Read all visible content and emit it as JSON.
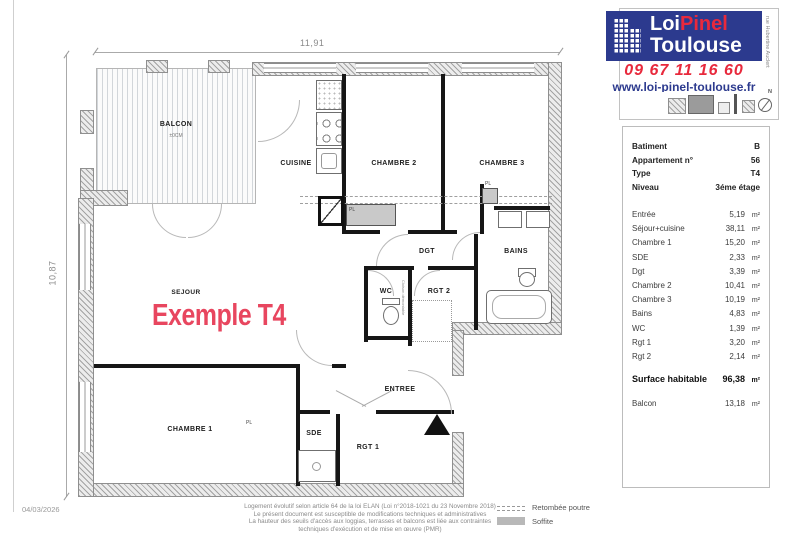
{
  "branding": {
    "logo": {
      "word1": "Loi",
      "word2": "Pinel",
      "word3": "Toulouse"
    },
    "phone": "09 67 11 16 60",
    "website": "www.loi-pinel-toulouse.fr",
    "street": "rue Hubertine Auclert",
    "compass": "N",
    "colors": {
      "navy": "#2c3a8e",
      "red": "#e8293c",
      "pink": "#e8465f"
    }
  },
  "info_panel": {
    "header": [
      {
        "label": "Batiment",
        "value": "B"
      },
      {
        "label": "Appartement n°",
        "value": "56"
      },
      {
        "label": "Type",
        "value": "T4"
      },
      {
        "label": "Niveau",
        "value": "3éme étage"
      }
    ],
    "rooms": [
      {
        "label": "Entrée",
        "value": "5,19",
        "unit": "m²"
      },
      {
        "label": "Séjour+cuisine",
        "value": "38,11",
        "unit": "m²"
      },
      {
        "label": "Chambre 1",
        "value": "15,20",
        "unit": "m²"
      },
      {
        "label": "SDE",
        "value": "2,33",
        "unit": "m²"
      },
      {
        "label": "Dgt",
        "value": "3,39",
        "unit": "m²"
      },
      {
        "label": "Chambre 2",
        "value": "10,41",
        "unit": "m²"
      },
      {
        "label": "Chambre 3",
        "value": "10,19",
        "unit": "m²"
      },
      {
        "label": "Bains",
        "value": "4,83",
        "unit": "m²"
      },
      {
        "label": "WC",
        "value": "1,39",
        "unit": "m²"
      },
      {
        "label": "Rgt 1",
        "value": "3,20",
        "unit": "m²"
      },
      {
        "label": "Rgt 2",
        "value": "2,14",
        "unit": "m²"
      }
    ],
    "total": {
      "label": "Surface habitable",
      "value": "96,38",
      "unit": "m²"
    },
    "balcony": {
      "label": "Balcon",
      "value": "13,18",
      "unit": "m²"
    }
  },
  "plan": {
    "title": "Exemple T4",
    "dim_width": "11,91",
    "dim_height": "10,87",
    "labels": {
      "balcon": "BALCON",
      "balcon_note": "±0CM",
      "cuisine": "CUISINE",
      "chambre2": "CHAMBRE 2",
      "chambre3": "CHAMBRE 3",
      "sejour": "SEJOUR",
      "dgt": "DGT",
      "bains": "BAINS",
      "wc": "WC",
      "rgt2": "RGT 2",
      "entree": "ENTREE",
      "chambre1": "CHAMBRE 1",
      "sde": "SDE",
      "rgt1": "RGT 1",
      "pl": "PL",
      "cloison": "Cloison démontable"
    }
  },
  "legend": {
    "items": [
      {
        "label": "Retombée poutre"
      },
      {
        "label": "Soffite"
      }
    ]
  },
  "footer": {
    "date": "04/03/2026",
    "line1": "Logement évolutif selon article 64 de la loi ELAN (Loi n°2018-1021 du 23 Novembre 2018)",
    "line2": "Le présent document est susceptible de modifications techniques et administratives",
    "line3": "La hauteur des seuils d'accès aux loggias, terrasses et balcons est liée aux contraintes",
    "line4": "techniques d'exécution et de mise en œuvre (PMR)"
  }
}
